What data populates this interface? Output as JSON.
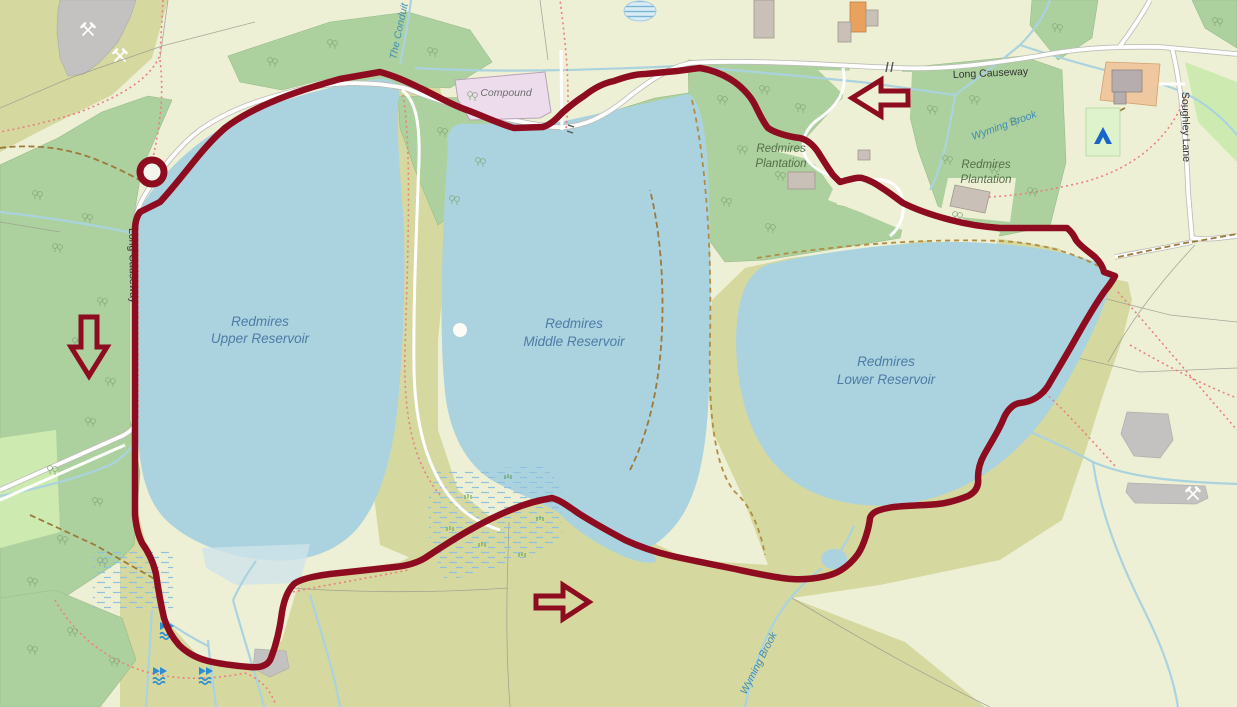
{
  "map": {
    "description": "OSM-style walking route map of Redmires Reservoirs",
    "colors": {
      "water": "#aad3df",
      "woodland": "#add19e",
      "heath": "#d6d99f",
      "farmland": "#eef0d5",
      "meadow": "#cdebb0",
      "route": "#8d0c20",
      "quarry": "#c3c2c0",
      "compound_fill": "#eddcec",
      "road_fill": "#ffffff",
      "road_casing": "#bdbdb6",
      "footpath_dotted": "#e98080",
      "track_dashed": "#9c7a3c"
    },
    "labels": {
      "upper_reservoir": {
        "line1": "Redmires",
        "line2": "Upper Reservoir"
      },
      "middle_reservoir": {
        "line1": "Redmires",
        "line2": "Middle Reservoir"
      },
      "lower_reservoir": {
        "line1": "Redmires",
        "line2": "Lower Reservoir"
      },
      "plantation_west": {
        "line1": "Redmires",
        "line2": "Plantation"
      },
      "plantation_east": {
        "line1": "Redmires",
        "line2": "Plantation"
      },
      "long_causeway_top": "Long Causeway",
      "long_causeway_west": "Long Causeway",
      "soughley_lane": "Soughley Lane",
      "wyming_brook_ne": "Wyming Brook",
      "wyming_brook_south": "Wyming Brook",
      "the_conduit": "The Conduit",
      "compound": "Compound"
    },
    "route": {
      "color": "#8d0c20",
      "start_marker": "circle",
      "direction": "anticlockwise",
      "arrows": [
        {
          "direction": "west",
          "position": "top, on Long Causeway clearing"
        },
        {
          "direction": "south",
          "position": "west woodland strip"
        },
        {
          "direction": "east",
          "position": "southern moorland"
        }
      ]
    },
    "icons": [
      "waterfall-icon",
      "campsite-icon",
      "mine-hammers-icon",
      "buoy-icon",
      "gate-icon",
      "tree-icon"
    ]
  }
}
